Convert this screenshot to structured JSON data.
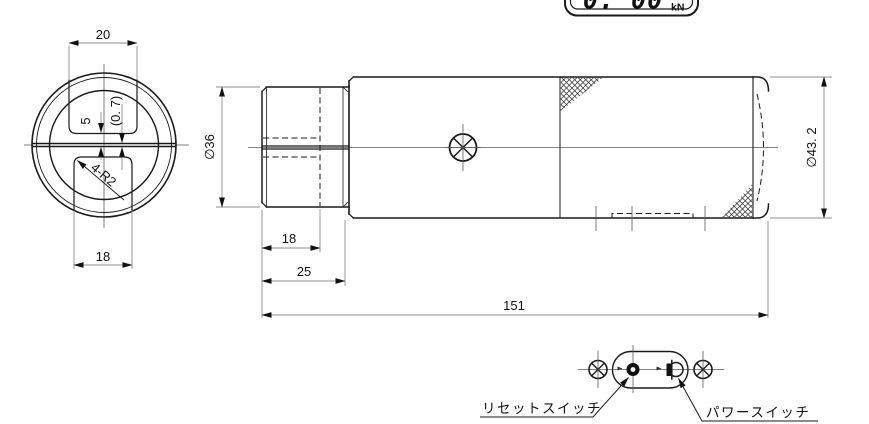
{
  "colors": {
    "object": "#1a1a1a",
    "dim": "#8e8e8e",
    "center": "#5a5a5a",
    "text": "#111111",
    "background": "#ffffff"
  },
  "display": {
    "value": "0. 00",
    "unit": "kN"
  },
  "front_view": {
    "dim_top_slot_width": "20",
    "dim_bottom_slot_width": "18",
    "dim_slot_to_center": "5",
    "dim_slit_width": "(0. 7)",
    "dim_corner_radius": "4-R2"
  },
  "side_view": {
    "dim_shaft_diameter": "∅36",
    "dim_thread_length": "18",
    "dim_shaft_length": "25",
    "dim_total_length": "151",
    "dim_body_diameter": "∅43. 2"
  },
  "bottom_view": {
    "reset_switch_label": "リセットスイッチ",
    "power_switch_label": "パワースイッチ"
  }
}
